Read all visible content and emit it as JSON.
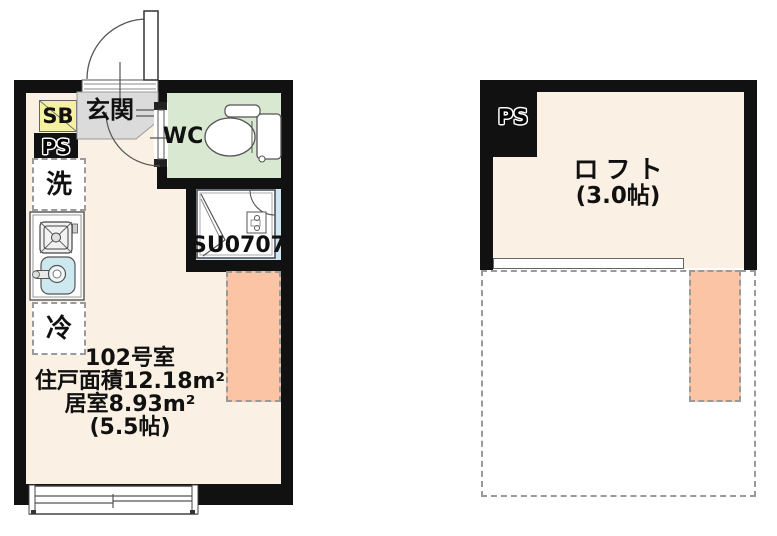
{
  "colors": {
    "wall": "#111111",
    "room_cream": "#FAF0E4",
    "entry_gray": "#DBDBDB",
    "wc_green": "#D9E8D0",
    "shower_blue": "#CFE7F0",
    "sink_blue": "#CDE9EF",
    "loft_salmon": "#FBC4A4",
    "sb_yellow": "#F4F1A1",
    "dash_gray": "#9A9A9A",
    "line_dark": "#555555"
  },
  "unit_plan": {
    "sb": "SB",
    "ps": "PS",
    "entry": "玄関",
    "wc": "WC",
    "washer": "洗",
    "fridge": "冷",
    "shower_unit": "SU0707",
    "room_no": "102号室",
    "total_area": "住戸面積12.18m²",
    "room_area": "居室8.93m²",
    "room_size": "(5.5帖)"
  },
  "loft_plan": {
    "ps": "PS",
    "loft": "ロフト",
    "loft_size": "(3.0帖)"
  }
}
